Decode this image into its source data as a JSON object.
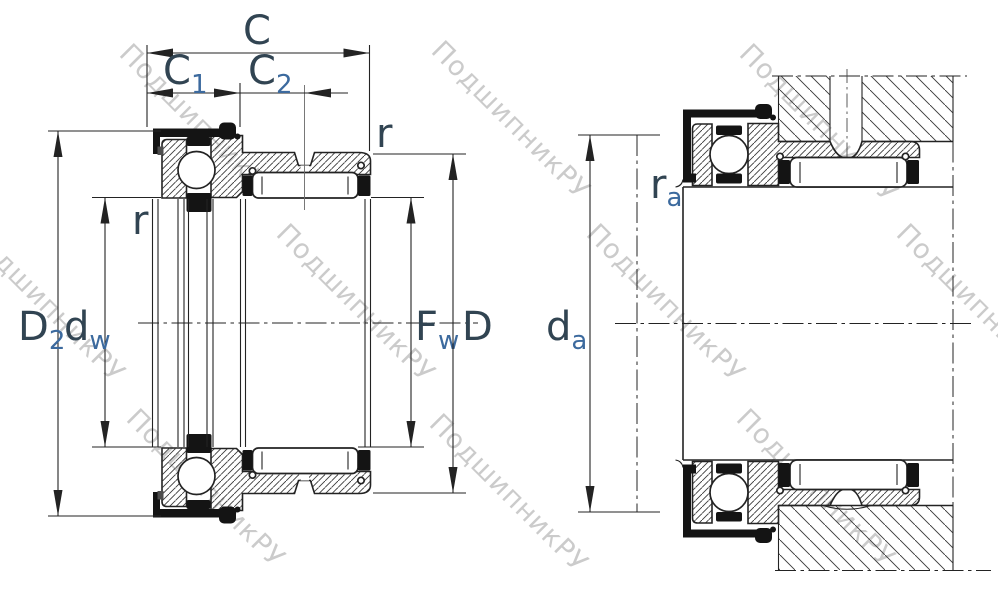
{
  "labels": {
    "c": "C",
    "c1": {
      "main": "C",
      "sub": "1"
    },
    "c2": {
      "main": "C",
      "sub": "2"
    },
    "r_left": "r",
    "r_right": "r",
    "d2": {
      "main": "D",
      "sub": "2"
    },
    "dw": {
      "main": "d",
      "sub": "w"
    },
    "fw": {
      "main": "F",
      "sub": "w"
    },
    "d_outer": "D",
    "da": {
      "main": "d",
      "sub": "a"
    },
    "ra": {
      "main": "r",
      "sub": "a"
    }
  },
  "watermark": {
    "text": "ПодшипникРУ"
  },
  "colors": {
    "line": "#232323",
    "label_main": "#314452",
    "label_sub": "#3c6a9e",
    "watermark": "#c9c9c9",
    "fill_dark": "#141414",
    "background": "#ffffff"
  }
}
